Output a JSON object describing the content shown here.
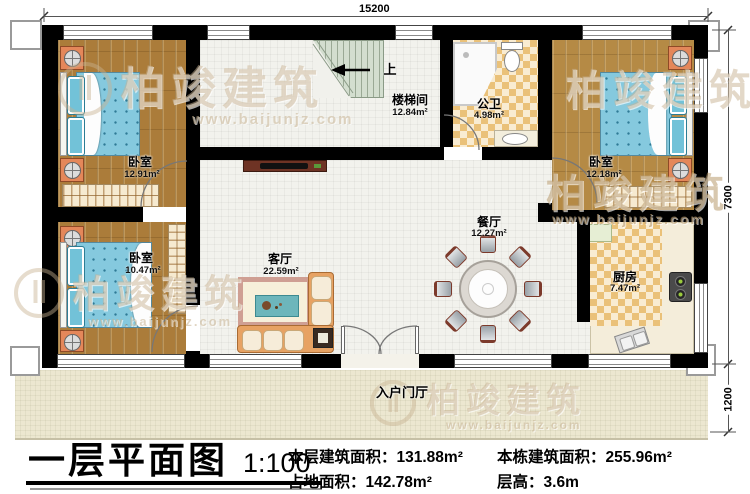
{
  "title_block": {
    "title": "一层平面图",
    "scale": "1:100",
    "stats": [
      {
        "label": "本层建筑面积：",
        "value": "131.88m²"
      },
      {
        "label": "占地面积：",
        "value": "142.78m²"
      },
      {
        "label": "本栋建筑面积：",
        "value": "255.96m²"
      },
      {
        "label": "层高：",
        "value": "3.6m"
      }
    ]
  },
  "dimensions": {
    "top": "15200",
    "right_upper": "7300",
    "right_lower": "1200"
  },
  "rooms": {
    "bedroom_tl": {
      "name": "卧室",
      "area": "12.91m²"
    },
    "bedroom_bl": {
      "name": "卧室",
      "area": "10.47m²"
    },
    "bedroom_tr": {
      "name": "卧室",
      "area": "12.18m²"
    },
    "stair_hall": {
      "name": "楼梯间",
      "area": "12.84m²"
    },
    "bathroom": {
      "name": "公卫",
      "area": "4.98m²"
    },
    "dining": {
      "name": "餐厅",
      "area": "12.27m²"
    },
    "living": {
      "name": "客厅",
      "area": "22.59m²"
    },
    "kitchen": {
      "name": "厨房",
      "area": "7.47m²"
    },
    "foyer": {
      "name": "入户门厅"
    }
  },
  "stairs": {
    "up": "上"
  },
  "watermark": {
    "brand": "柏竣建筑",
    "url": "www.baijunjz.com"
  },
  "colors": {
    "wall": "#000000",
    "wood": "#ab7c3a",
    "tile": "#f2f2ed",
    "bed": "#85c9de",
    "nightstand": "#e4875a"
  }
}
